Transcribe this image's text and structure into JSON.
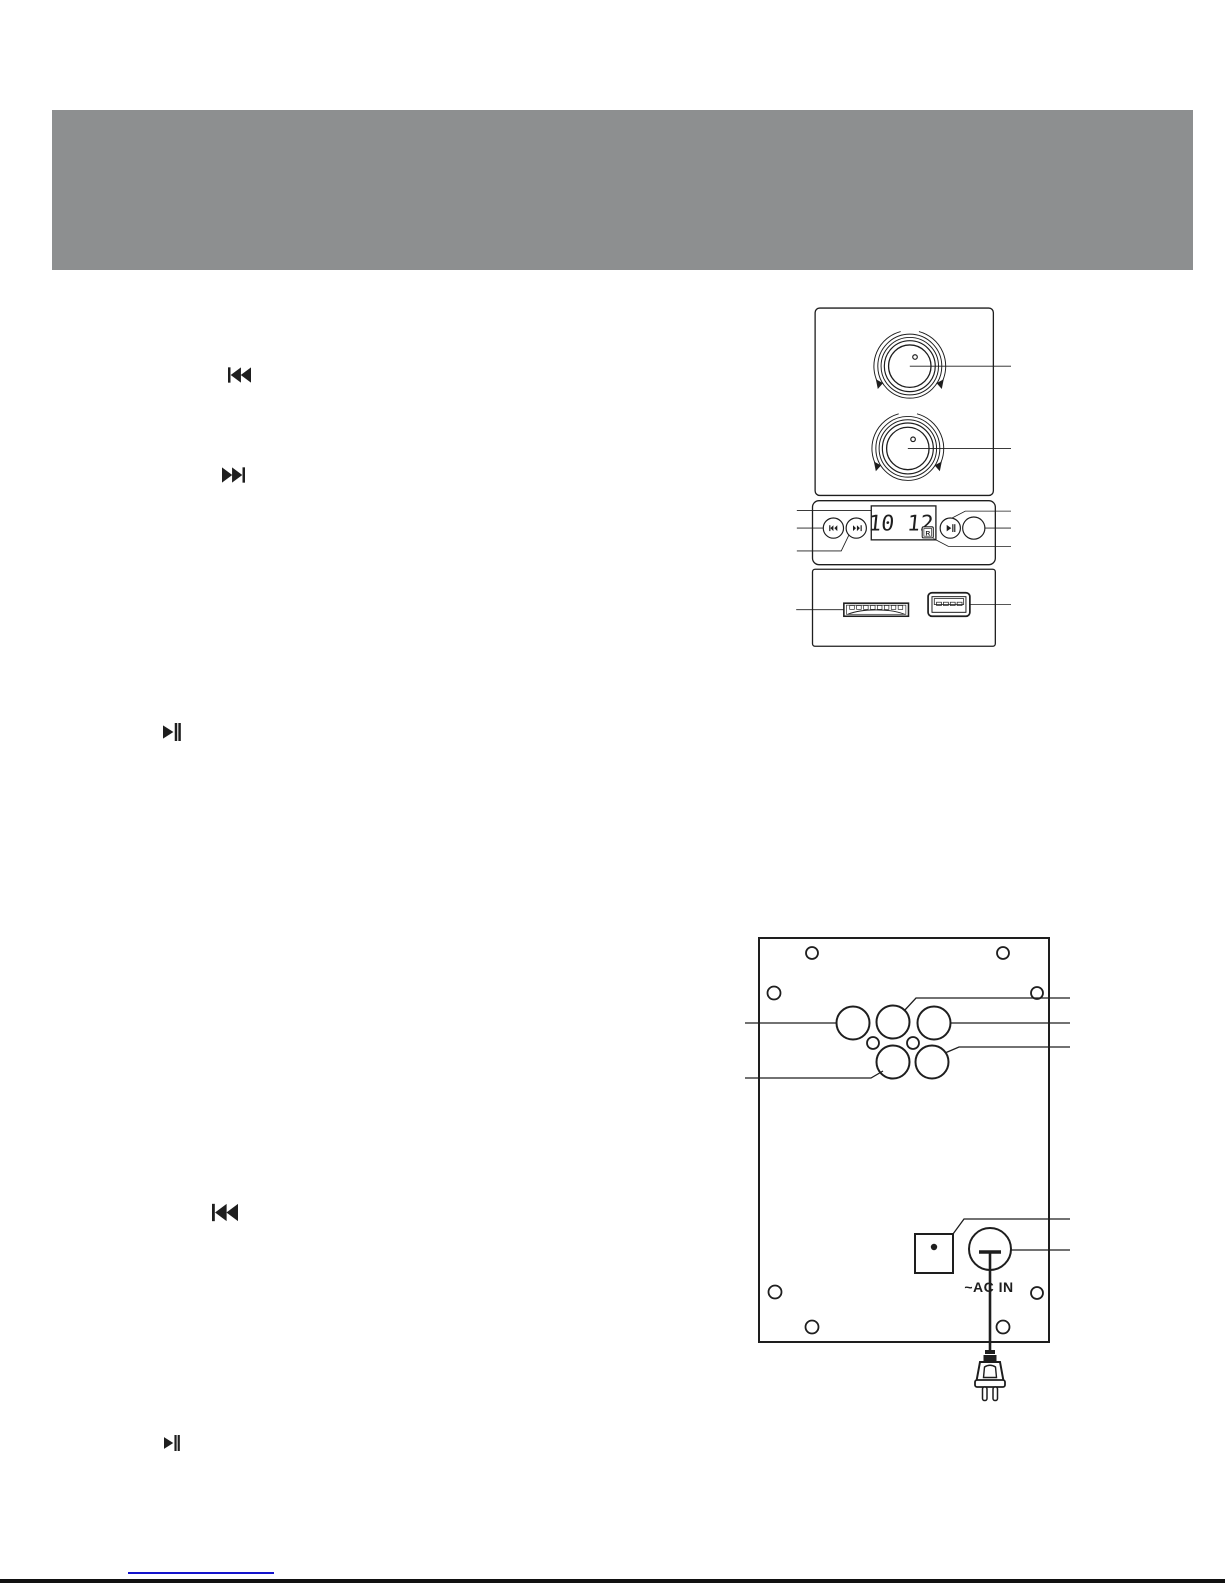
{
  "document": {
    "kind": "speaker manual diagram page"
  },
  "header": {
    "band_color": "#8D8F90"
  },
  "margin_icons": [
    {
      "name": "skip-back-icon",
      "glyph": "⏮"
    },
    {
      "name": "skip-forward-icon",
      "glyph": "⏭"
    },
    {
      "name": "play-pause-icon",
      "glyph": "⏯"
    },
    {
      "name": "skip-back-icon",
      "glyph": "⏮"
    },
    {
      "name": "play-pause-icon",
      "glyph": "⏯"
    }
  ],
  "front_panel": {
    "display_value": "10 12",
    "ir_sensor_glyph": "R"
  },
  "back_panel": {
    "ac_in_label": "~AC IN"
  },
  "colors": {
    "header_gray": "#8D8F90",
    "diagram_line": "#1E1E1E",
    "link_blue": "#1414CC",
    "page_edge_black": "#111111"
  }
}
